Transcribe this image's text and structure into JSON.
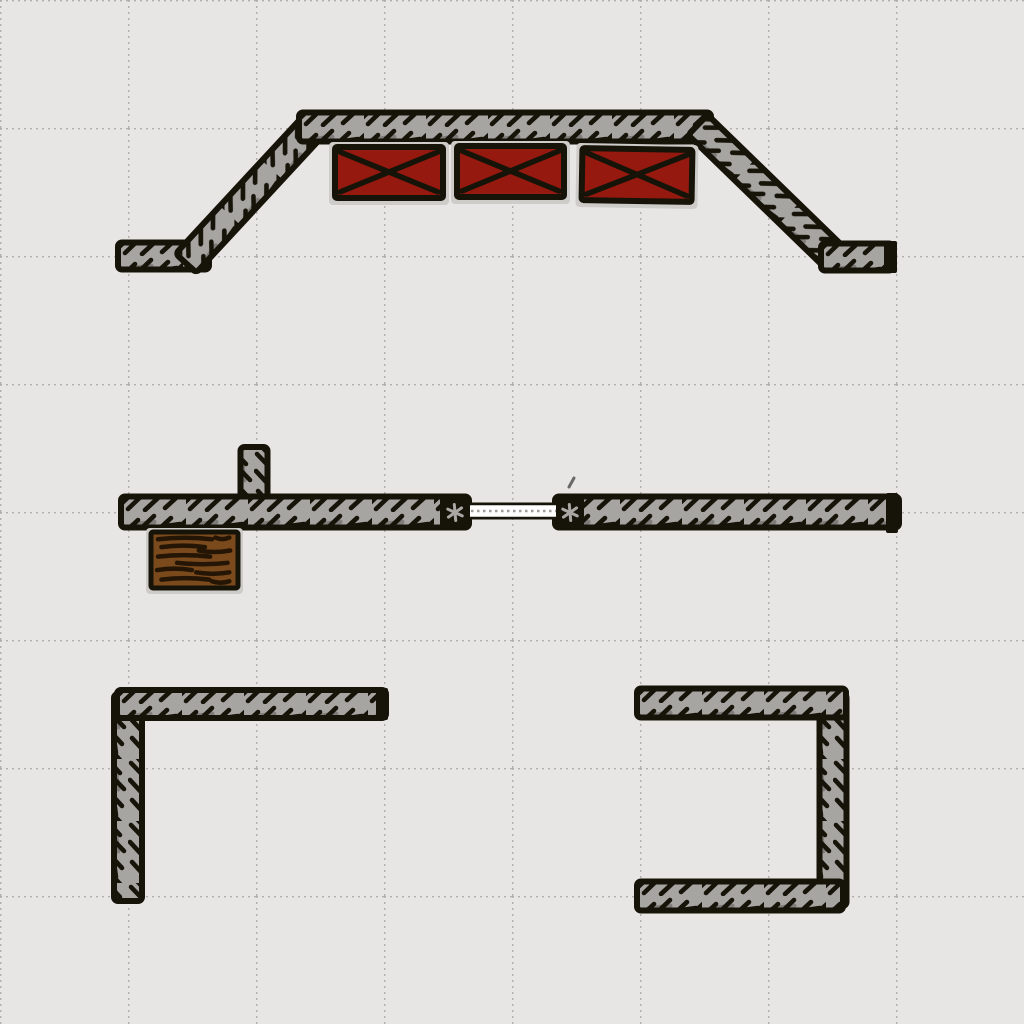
{
  "scene": {
    "width": 1024,
    "height": 1024,
    "background": "#e8e6e4",
    "grid": {
      "spacing": 128,
      "dot_color": "#b1afac",
      "style": "dotted"
    },
    "palette": {
      "bg": "#e8e6e4",
      "grid_dot": "#b1afac",
      "platform": "#a7a5a2",
      "platform_dark": "#7f7d7a",
      "ink": "#161309",
      "crate_red": "#96190f",
      "shadow": "#cdccc9",
      "wood": "#7a4a1d",
      "wood_streak": "#241504",
      "cap_star": "#a9a7a4",
      "link_dot": "#9f9d9a"
    },
    "objects": [
      {
        "name": "bridge-left-stub",
        "type": "beam",
        "x1": 121,
        "y1": 256,
        "x2": 206,
        "y2": 256,
        "t": 27,
        "interactable": false
      },
      {
        "name": "bridge-left-ramp",
        "type": "beam",
        "x1": 188,
        "y1": 261,
        "x2": 314,
        "y2": 125,
        "t": 28,
        "interactable": false
      },
      {
        "name": "bridge-top-beam",
        "type": "beam",
        "x1": 302,
        "y1": 127,
        "x2": 708,
        "y2": 127,
        "t": 29,
        "interactable": false
      },
      {
        "name": "bridge-right-ramp",
        "type": "beam",
        "x1": 700,
        "y1": 127,
        "x2": 836,
        "y2": 259,
        "t": 28,
        "interactable": false
      },
      {
        "name": "bridge-right-stub",
        "type": "beam",
        "x1": 824,
        "y1": 257,
        "x2": 890,
        "y2": 257,
        "t": 27,
        "interactable": false
      },
      {
        "name": "bridge-right-end-cap",
        "type": "cap",
        "x": 884,
        "y": 241,
        "w": 13,
        "h": 32,
        "star": false,
        "interactable": false
      },
      {
        "name": "red-crate-1",
        "type": "crate",
        "x": 335,
        "y": 147,
        "w": 108,
        "h": 51,
        "rot": 0,
        "interactable": true
      },
      {
        "name": "red-crate-2",
        "type": "crate",
        "x": 457,
        "y": 146,
        "w": 107,
        "h": 51,
        "rot": 0,
        "interactable": true
      },
      {
        "name": "red-crate-3",
        "type": "crate",
        "x": 582,
        "y": 149,
        "w": 110,
        "h": 52,
        "rot": 1,
        "interactable": true
      },
      {
        "name": "middle-post",
        "type": "beam",
        "x1": 254,
        "y1": 450,
        "x2": 254,
        "y2": 505,
        "t": 27,
        "interactable": false
      },
      {
        "name": "middle-left-beam",
        "type": "beam",
        "x1": 124,
        "y1": 512,
        "x2": 466,
        "y2": 512,
        "t": 31,
        "interactable": false
      },
      {
        "name": "middle-right-beam",
        "type": "beam",
        "x1": 558,
        "y1": 512,
        "x2": 896,
        "y2": 512,
        "t": 31,
        "interactable": false
      },
      {
        "name": "wood-log-crate",
        "type": "wood",
        "x": 151,
        "y": 532,
        "w": 87,
        "h": 56,
        "interactable": true
      },
      {
        "name": "rope-link",
        "type": "link",
        "x1": 471,
        "y1": 511,
        "x2": 556,
        "y2": 511,
        "interactable": true
      },
      {
        "name": "middle-left-joint-cap",
        "type": "cap",
        "x": 440,
        "y": 497,
        "w": 30,
        "h": 31,
        "star": true,
        "interactable": false
      },
      {
        "name": "middle-right-joint-cap",
        "type": "cap",
        "x": 556,
        "y": 497,
        "w": 28,
        "h": 31,
        "star": true,
        "interactable": false
      },
      {
        "name": "middle-right-end-cap",
        "type": "cap",
        "x": 886,
        "y": 493,
        "w": 12,
        "h": 40,
        "star": false,
        "interactable": false
      },
      {
        "name": "pen-mark",
        "type": "tick",
        "x1": 569,
        "y1": 487,
        "x2": 574,
        "y2": 478,
        "interactable": false
      },
      {
        "name": "bottom-left-vertical-beam",
        "type": "beam",
        "x1": 128,
        "y1": 697,
        "x2": 128,
        "y2": 898,
        "t": 28,
        "interactable": false
      },
      {
        "name": "bottom-left-horizontal-beam",
        "type": "beam",
        "x1": 120,
        "y1": 704,
        "x2": 383,
        "y2": 704,
        "t": 28,
        "interactable": false
      },
      {
        "name": "bottom-left-beam-end-cap",
        "type": "cap",
        "x": 376,
        "y": 688,
        "w": 12,
        "h": 32,
        "star": false,
        "interactable": false
      },
      {
        "name": "bottom-right-vertical-beam",
        "type": "beam",
        "x1": 833,
        "y1": 697,
        "x2": 833,
        "y2": 903,
        "t": 27,
        "interactable": false
      },
      {
        "name": "bottom-right-top-beam",
        "type": "beam",
        "x1": 640,
        "y1": 703,
        "x2": 843,
        "y2": 703,
        "t": 29,
        "interactable": false
      },
      {
        "name": "bottom-right-bottom-beam",
        "type": "beam",
        "x1": 640,
        "y1": 896,
        "x2": 840,
        "y2": 896,
        "t": 29,
        "interactable": false
      }
    ]
  }
}
